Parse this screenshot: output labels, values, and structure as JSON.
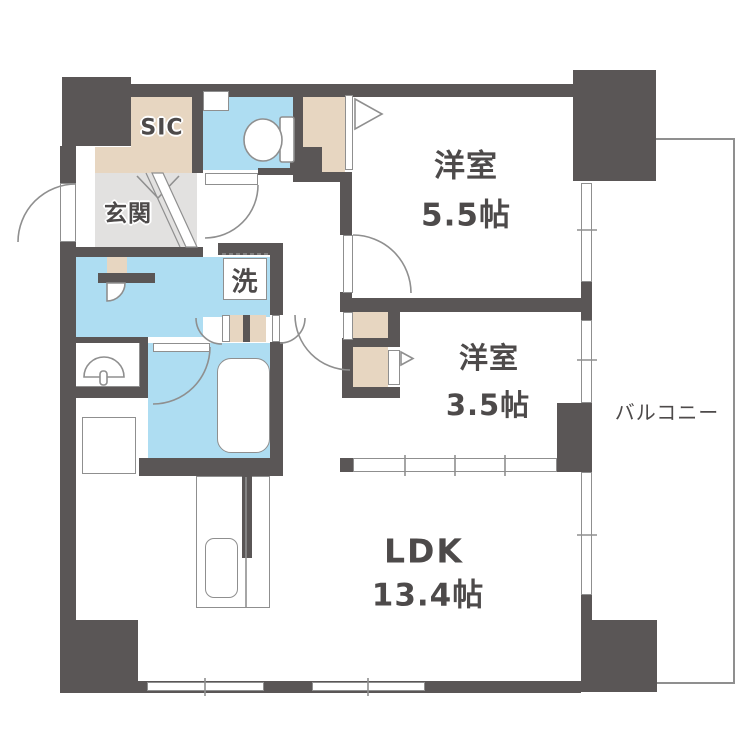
{
  "plan_title": "apartment-floor-plan",
  "rooms": {
    "bedroom1": {
      "name": "洋室",
      "size": "5.5帖"
    },
    "bedroom2": {
      "name": "洋室",
      "size": "3.5帖"
    },
    "ldk": {
      "name": "LDK",
      "size": "13.4帖"
    },
    "balcony": {
      "name": "バルコニー"
    },
    "entrance": {
      "name": "玄関"
    },
    "shoe_closet": {
      "name": "SIC"
    },
    "laundry": {
      "name": "洗"
    }
  },
  "colors": {
    "wall": "#5a5656",
    "closet": "#e7d6c1",
    "wet-area": "#aeddf2",
    "entrance-floor": "#e2e1e0",
    "line": "#8f8f8f",
    "label": "#4d4a4a"
  }
}
